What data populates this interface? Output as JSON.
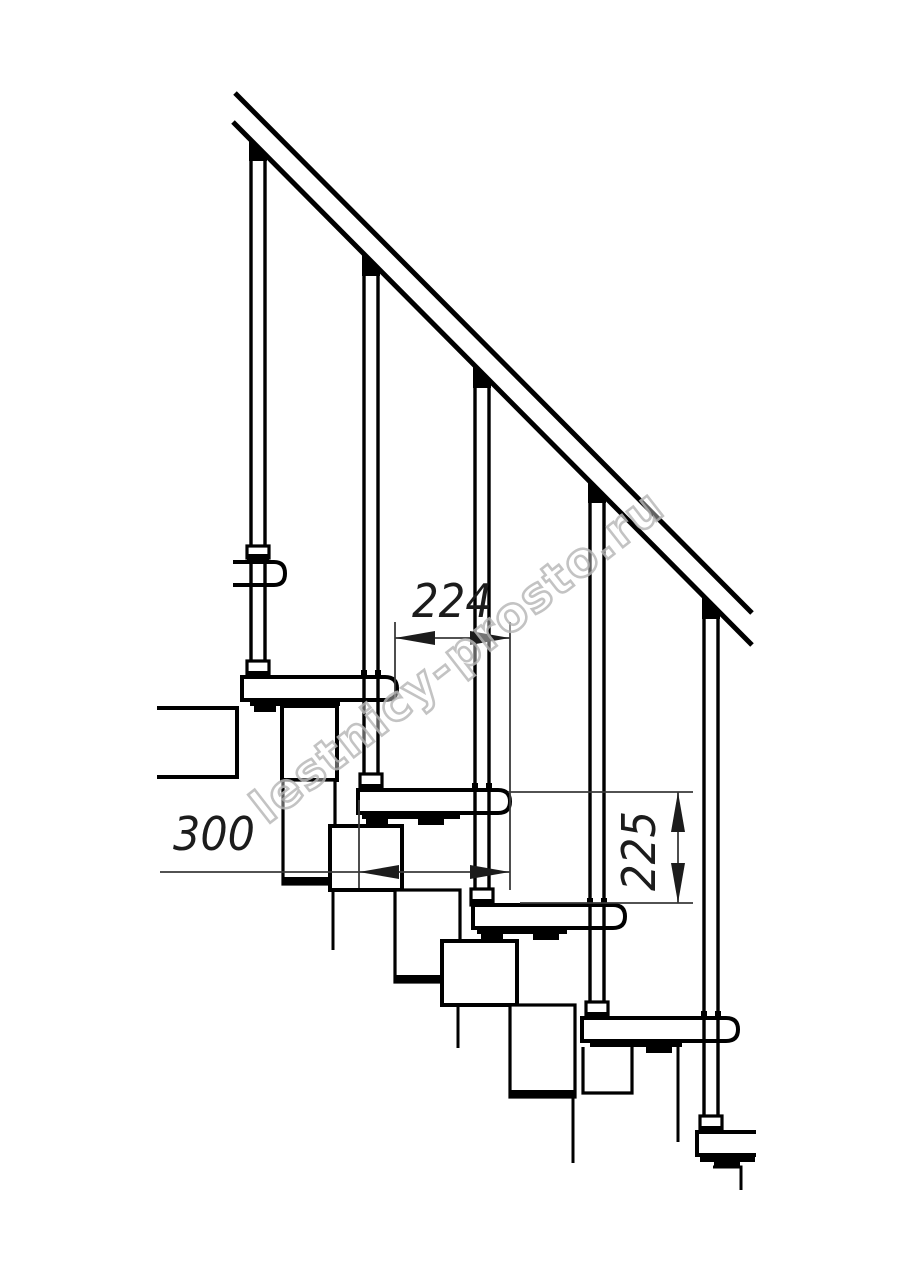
{
  "drawing": {
    "type": "technical-line-drawing",
    "subject": "modular staircase side elevation fragment",
    "dimensions": {
      "step_run": "224",
      "tread_depth": "300",
      "step_rise": "225"
    },
    "watermark": "lestnicy-prosto.ru",
    "colors": {
      "line": "#000000",
      "dimension_line": "#3a3a3a",
      "watermark_outline": "#b9b9b9",
      "background": "#ffffff"
    }
  }
}
